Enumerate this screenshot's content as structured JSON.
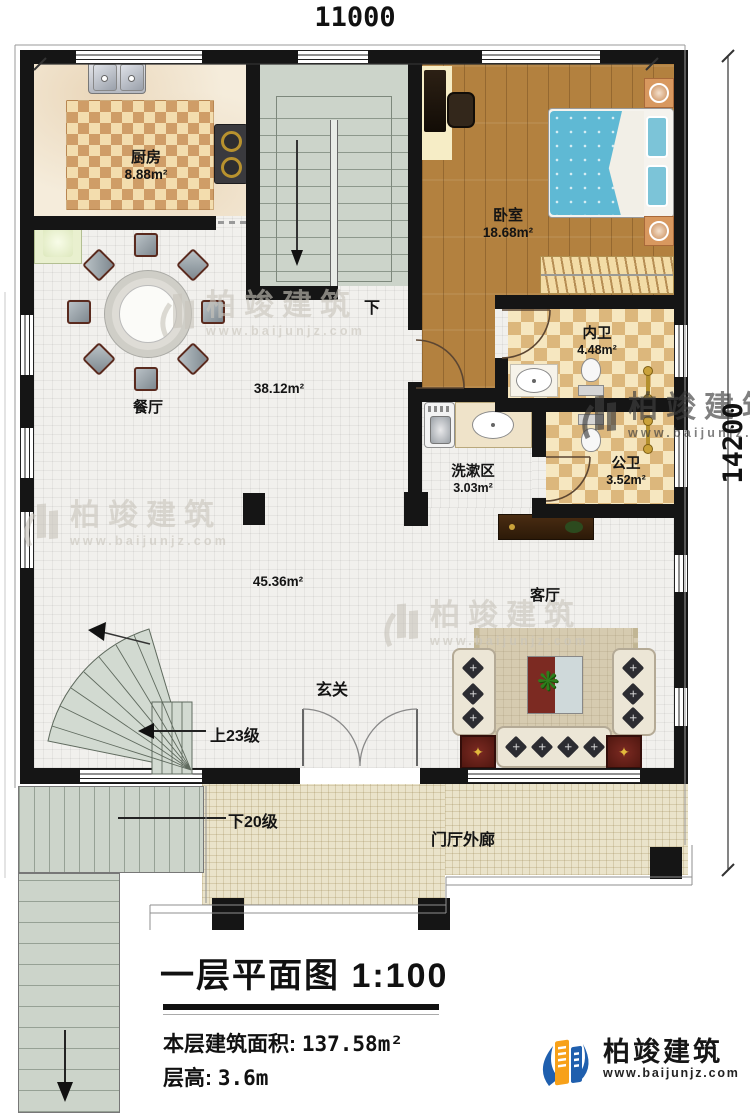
{
  "plan": {
    "dimensions": {
      "width_label": "11000",
      "height_label": "14200"
    },
    "rooms": {
      "kitchen": {
        "name": "厨房",
        "area": "8.88m²"
      },
      "dining": {
        "name": "餐厅",
        "area": "38.12m²"
      },
      "bedroom": {
        "name": "卧室",
        "area": "18.68m²"
      },
      "inner_bath": {
        "name": "内卫",
        "area": "4.48m²"
      },
      "public_bath": {
        "name": "公卫",
        "area": "3.52m²"
      },
      "wash_area": {
        "name": "洗漱区",
        "area": "3.03m²"
      },
      "living": {
        "name": "客厅",
        "area": "45.36m²"
      },
      "foyer": {
        "name": "玄关"
      },
      "porch": {
        "name": "门厅外廊"
      }
    },
    "stairs": {
      "down_marker": "下",
      "up_steps": "上23级",
      "down_steps": "下20级"
    }
  },
  "title_block": {
    "title": "一层平面图",
    "scale": "1:100",
    "area_label": "本层建筑面积:",
    "area_value": "137.58m²",
    "height_label": "层高:",
    "height_value": "3.6m"
  },
  "branding": {
    "company": "柏竣建筑",
    "website": "www.baijunjz.com",
    "logo_blue": "#1f5fae",
    "logo_orange": "#f7a11a"
  },
  "watermark": {
    "company": "柏竣建筑",
    "website": "www.baijunjz.com"
  },
  "icons": {
    "cushion": "✕",
    "star": "✦",
    "plant": "❋"
  }
}
